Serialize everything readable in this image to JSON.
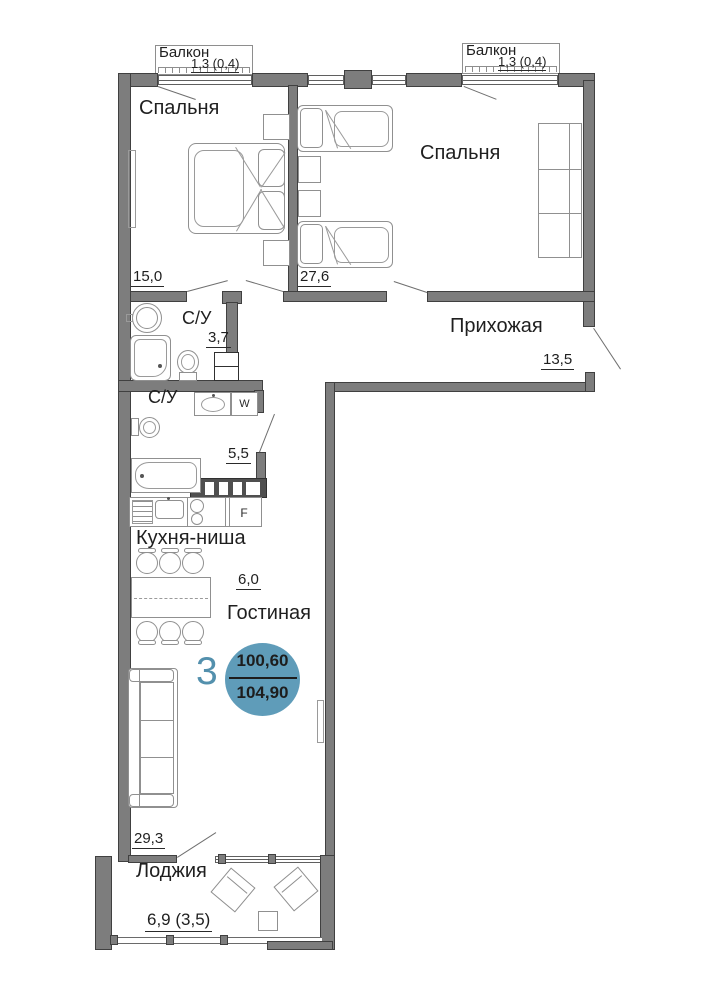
{
  "rooms": {
    "bedroom_left": {
      "name": "Спальня",
      "area": "15,0"
    },
    "bedroom_right": {
      "name": "Спальня",
      "area": "27,6"
    },
    "hallway": {
      "name": "Прихожая",
      "area": "13,5"
    },
    "bath_top": {
      "name": "С/У",
      "area": "3,7"
    },
    "bath_bottom": {
      "name": "С/У",
      "area": "5,5"
    },
    "kitchen": {
      "name": "Кухня-ниша",
      "area": "6,0"
    },
    "living": {
      "name": "Гостиная",
      "area": "29,3"
    },
    "loggia": {
      "name": "Лоджия",
      "area": "6,9 (3,5)"
    },
    "balcony_left": {
      "name": "Балкон",
      "area": "1,3 (0,4)"
    },
    "balcony_right": {
      "name": "Балкон",
      "area": "1,3 (0,4)"
    }
  },
  "badge": {
    "rooms_count": "3",
    "upper_area": "100,60",
    "lower_area": "104,90",
    "circle_color": "#5f9cb9",
    "accent_color": "#5390ad",
    "text_color": "#1d1d1d"
  },
  "appliances": {
    "washer_label": "W",
    "fridge_label": "F"
  }
}
